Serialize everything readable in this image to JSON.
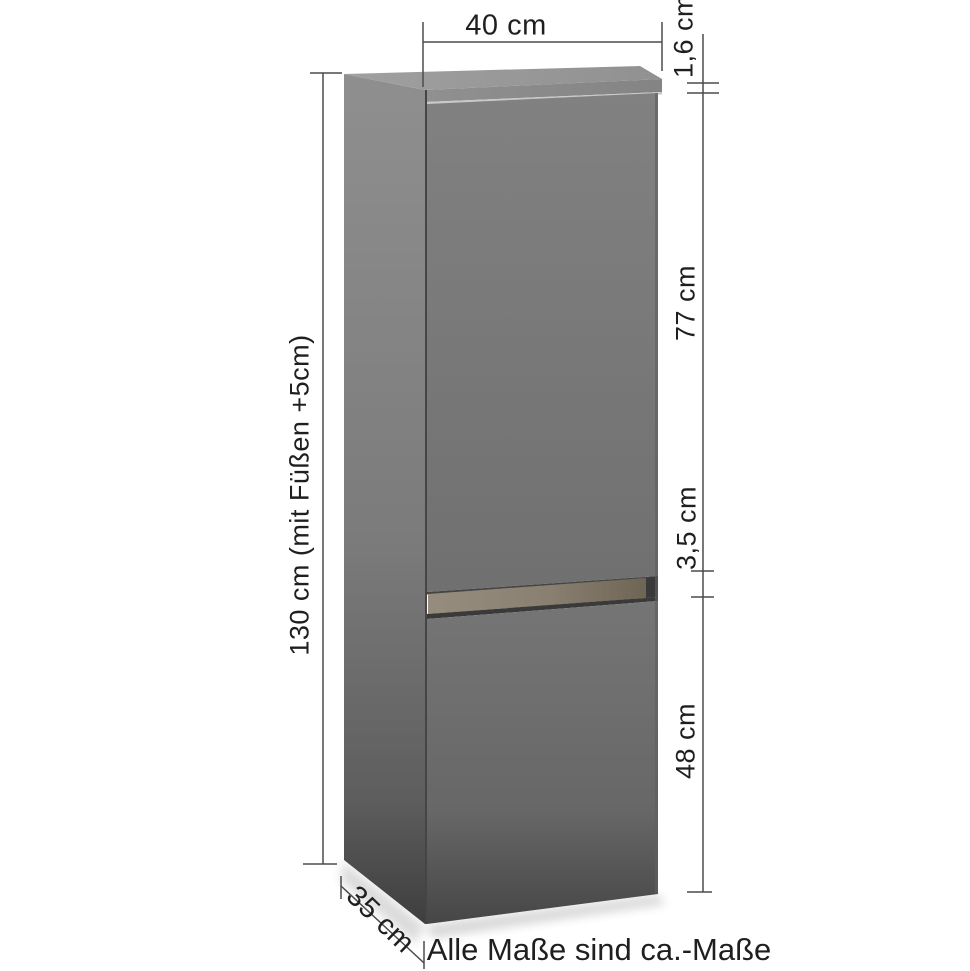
{
  "diagram": {
    "note": "Alle Maße sind ca.-Maße",
    "dimensions": {
      "width": {
        "label": "40 cm",
        "value_cm": 40
      },
      "top_thickness": {
        "label": "1,6 cm",
        "value_cm": 1.6
      },
      "upper_door_height": {
        "label": "77 cm",
        "value_cm": 77
      },
      "door_gap": {
        "label": "3,5 cm",
        "value_cm": 3.5
      },
      "lower_door_height": {
        "label": "48 cm",
        "value_cm": 48
      },
      "total_height": {
        "label": "130 cm (mit Füßen +5cm)",
        "value_cm": 130
      },
      "depth": {
        "label": "35 cm",
        "value_cm": 35
      }
    }
  },
  "colors": {
    "background": "#ffffff",
    "text": "#1f1f1f",
    "dimension-line": "#4c4c4c",
    "top-face": "#a0a0a0",
    "top-face-dark": "#919191",
    "top-strip": "#909090",
    "top-strip-dark": "#848484",
    "edge-gap-light": "#c9c9c9",
    "side-top": "#8f8f8f",
    "side-mid": "#7b7b7b",
    "side-low": "#5e5e5e",
    "side-bottom": "#3e3e3e",
    "door-upper-top": "#818181",
    "door-upper-bottom": "#707070",
    "door-lower-top": "#757575",
    "door-lower-mid": "#676767",
    "door-lower-bottom": "#464646",
    "wood-light": "#978d7e",
    "wood-mid": "#8a8071",
    "wood-dark": "#6e6555",
    "recess-dark": "#3a3a3a",
    "front-gap-dark": "#454545",
    "edge-dark": "#606060"
  }
}
